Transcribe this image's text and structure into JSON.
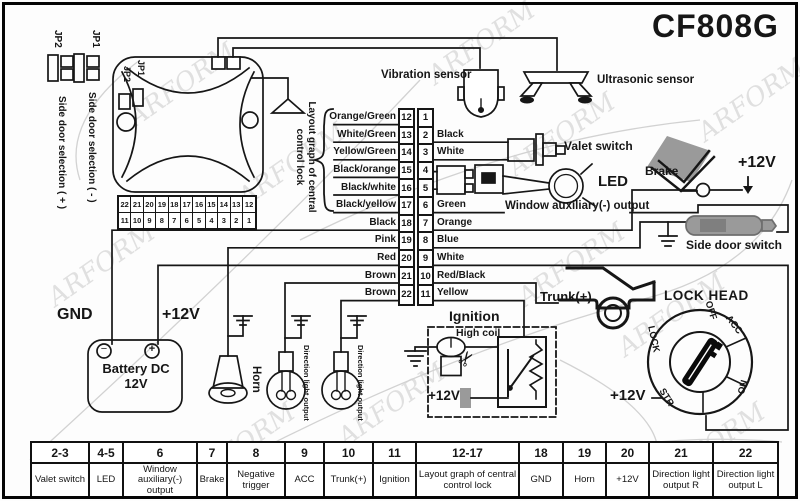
{
  "title": "CF808G",
  "watermark": "ARFORM",
  "icons": {
    "scissors": "✂",
    "minus": "−",
    "plus": "+"
  },
  "jumpers": {
    "jp1": "JP1",
    "jp2": "JP2",
    "jp1_text": "Side door selection ( - )",
    "jp2_text": "Side door selection ( + )"
  },
  "unit": {
    "jp1": "JP1",
    "jp2": "JP2",
    "strip_top": [
      "22",
      "21",
      "20",
      "19",
      "18",
      "17",
      "16",
      "15",
      "14",
      "13",
      "12"
    ],
    "strip_bottom": [
      "11",
      "10",
      "9",
      "8",
      "7",
      "6",
      "5",
      "4",
      "3",
      "2",
      "1"
    ]
  },
  "sensors": {
    "vibration": "Vibration sensor",
    "ultrasonic": "Ultrasonic sensor"
  },
  "connector": {
    "bracket_label": "Layout graph of central control lock",
    "rows": [
      {
        "left_pin": "12",
        "right_pin": "1",
        "left_wire": "Orange/Green",
        "right_wire": ""
      },
      {
        "left_pin": "13",
        "right_pin": "2",
        "left_wire": "White/Green",
        "right_wire": "Black"
      },
      {
        "left_pin": "14",
        "right_pin": "3",
        "left_wire": "Yellow/Green",
        "right_wire": "White"
      },
      {
        "left_pin": "15",
        "right_pin": "4",
        "left_wire": "Black/orange",
        "right_wire": ""
      },
      {
        "left_pin": "16",
        "right_pin": "5",
        "left_wire": "Black/white",
        "right_wire": ""
      },
      {
        "left_pin": "17",
        "right_pin": "6",
        "left_wire": "Black/yellow",
        "right_wire": "Green"
      },
      {
        "left_pin": "18",
        "right_pin": "7",
        "left_wire": "Black",
        "right_wire": "Orange"
      },
      {
        "left_pin": "19",
        "right_pin": "8",
        "left_wire": "Pink",
        "right_wire": "Blue"
      },
      {
        "left_pin": "20",
        "right_pin": "9",
        "left_wire": "Red",
        "right_wire": "White"
      },
      {
        "left_pin": "21",
        "right_pin": "10",
        "left_wire": "Brown",
        "right_wire": "Red/Black"
      },
      {
        "left_pin": "22",
        "right_pin": "11",
        "left_wire": "Brown",
        "right_wire": "Yellow"
      }
    ]
  },
  "components": {
    "valet": "Valet switch",
    "led": "LED",
    "window_aux": "Window auxiliary(-) output",
    "brake": "Brake",
    "brake_supply": "+12V",
    "side_door": "Side door switch",
    "trunk": "Trunk(+)"
  },
  "ignition": {
    "title": "Ignition",
    "coil": "High coil",
    "supply": "+12V"
  },
  "power": {
    "gnd": "GND",
    "supply": "+12V",
    "battery_line1": "Battery DC",
    "battery_line2": "12V",
    "horn": "Horn",
    "direction": "Direction light output"
  },
  "lock_head": {
    "title": "LOCK HEAD",
    "supply": "+12V",
    "positions": [
      "OFF",
      "ACC",
      "ON",
      "STR",
      "LOCK"
    ]
  },
  "table": {
    "columns": [
      {
        "pin": "2-3",
        "label": "Valet switch"
      },
      {
        "pin": "4-5",
        "label": "LED"
      },
      {
        "pin": "6",
        "label": "Window auxiliary(-) output"
      },
      {
        "pin": "7",
        "label": "Brake"
      },
      {
        "pin": "8",
        "label": "Negative trigger"
      },
      {
        "pin": "9",
        "label": "ACC"
      },
      {
        "pin": "10",
        "label": "Trunk(+)"
      },
      {
        "pin": "11",
        "label": "Ignition"
      },
      {
        "pin": "12-17",
        "label": "Layout graph of central control lock"
      },
      {
        "pin": "18",
        "label": "GND"
      },
      {
        "pin": "19",
        "label": "Horn"
      },
      {
        "pin": "20",
        "label": "+12V"
      },
      {
        "pin": "21",
        "label": "Direction light output R"
      },
      {
        "pin": "22",
        "label": "Direction light output L"
      }
    ]
  }
}
